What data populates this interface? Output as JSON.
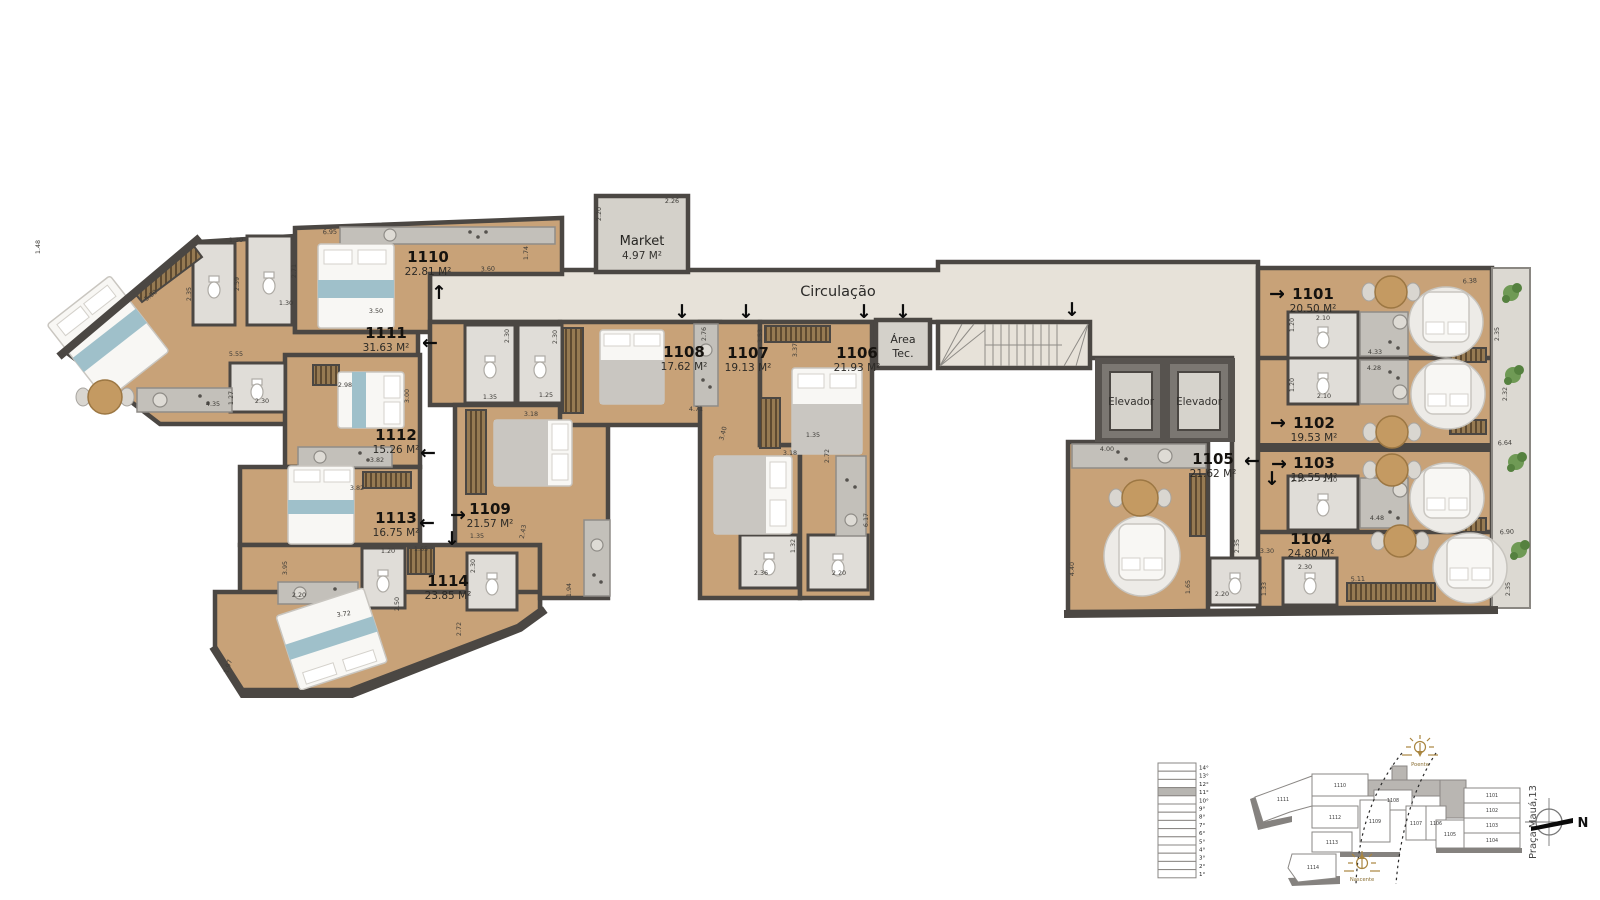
{
  "plan": {
    "rooms": {
      "market": {
        "name": "Market",
        "area": "4.97 M²",
        "x": 642,
        "y": 241
      },
      "circulation": {
        "name": "Circulação",
        "x": 838,
        "y": 292
      },
      "area_tec": {
        "line1": "Área",
        "line2": "Tec.",
        "x": 903,
        "y": 342
      },
      "elevators": [
        {
          "label": "Elevador",
          "x": 1131,
          "y": 405
        },
        {
          "label": "Elevador",
          "x": 1199,
          "y": 405
        }
      ]
    },
    "units": [
      {
        "number": "1110",
        "area": "22.81 M²",
        "x": 428,
        "y": 262
      },
      {
        "number": "1111",
        "area": "31.63 M²",
        "x": 386,
        "y": 338
      },
      {
        "number": "1112",
        "area": "15.26 M²",
        "x": 396,
        "y": 440
      },
      {
        "number": "1113",
        "area": "16.75 M²",
        "x": 396,
        "y": 523
      },
      {
        "number": "1114",
        "area": "23.85 M²",
        "x": 448,
        "y": 586
      },
      {
        "number": "1109",
        "area": "21.57 M²",
        "x": 490,
        "y": 514
      },
      {
        "number": "1108",
        "area": "17.62 M²",
        "x": 684,
        "y": 357
      },
      {
        "number": "1107",
        "area": "19.13 M²",
        "x": 748,
        "y": 358
      },
      {
        "number": "1106",
        "area": "21.93 M²",
        "x": 857,
        "y": 358
      },
      {
        "number": "1105",
        "area": "21.62 M²",
        "x": 1213,
        "y": 464
      },
      {
        "number": "1101",
        "area": "20.50 M²",
        "x": 1313,
        "y": 299
      },
      {
        "number": "1102",
        "area": "19.53 M²",
        "x": 1314,
        "y": 428
      },
      {
        "number": "1103",
        "area": "19.55 M²",
        "x": 1314,
        "y": 468
      },
      {
        "number": "1104",
        "area": "24.80 M²",
        "x": 1311,
        "y": 544
      }
    ],
    "dimensions": [
      {
        "t": "5.00",
        "x": 152,
        "y": 297,
        "r": -38
      },
      {
        "t": "2.35",
        "x": 191,
        "y": 294,
        "r": -90
      },
      {
        "t": "1.48",
        "x": 40,
        "y": 247,
        "r": -90
      },
      {
        "t": "1.30",
        "x": 236,
        "y": 242,
        "r": 0
      },
      {
        "t": "2.59",
        "x": 239,
        "y": 284,
        "r": -90
      },
      {
        "t": "2.71",
        "x": 296,
        "y": 271,
        "r": -90
      },
      {
        "t": "1.30",
        "x": 286,
        "y": 305,
        "r": 0
      },
      {
        "t": "6.95",
        "x": 330,
        "y": 234,
        "r": -2
      },
      {
        "t": "3.50",
        "x": 376,
        "y": 313,
        "r": 0
      },
      {
        "t": "3.60",
        "x": 488,
        "y": 271,
        "r": -3
      },
      {
        "t": "1.74",
        "x": 528,
        "y": 253,
        "r": -90
      },
      {
        "t": "2.20",
        "x": 601,
        "y": 214,
        "r": -90
      },
      {
        "t": "2.26",
        "x": 672,
        "y": 203,
        "r": 0
      },
      {
        "t": "5.55",
        "x": 236,
        "y": 356,
        "r": 0
      },
      {
        "t": "1.27",
        "x": 233,
        "y": 398,
        "r": -90
      },
      {
        "t": "4.35",
        "x": 213,
        "y": 406,
        "r": 0
      },
      {
        "t": "2.30",
        "x": 262,
        "y": 403,
        "r": 0
      },
      {
        "t": "2.98",
        "x": 345,
        "y": 387,
        "r": 0
      },
      {
        "t": "3.00",
        "x": 409,
        "y": 396,
        "r": -90
      },
      {
        "t": "3.82",
        "x": 377,
        "y": 462,
        "r": 0
      },
      {
        "t": "3.82",
        "x": 357,
        "y": 490,
        "r": 0
      },
      {
        "t": "3.95",
        "x": 287,
        "y": 568,
        "r": -90
      },
      {
        "t": "2.20",
        "x": 299,
        "y": 597,
        "r": 0
      },
      {
        "t": "1.20",
        "x": 388,
        "y": 553,
        "r": 0
      },
      {
        "t": "1.65",
        "x": 421,
        "y": 551,
        "r": 0
      },
      {
        "t": "2.50",
        "x": 399,
        "y": 604,
        "r": -90
      },
      {
        "t": "3.72",
        "x": 344,
        "y": 616,
        "r": -8
      },
      {
        "t": "1.97",
        "x": 230,
        "y": 667,
        "r": -72
      },
      {
        "t": "2.72",
        "x": 461,
        "y": 629,
        "r": -90
      },
      {
        "t": "2.30",
        "x": 475,
        "y": 566,
        "r": -90
      },
      {
        "t": "1.94",
        "x": 571,
        "y": 590,
        "r": -90
      },
      {
        "t": "2.30",
        "x": 509,
        "y": 336,
        "r": -90
      },
      {
        "t": "2.30",
        "x": 557,
        "y": 337,
        "r": -90
      },
      {
        "t": "1.35",
        "x": 490,
        "y": 399,
        "r": 0
      },
      {
        "t": "1.25",
        "x": 546,
        "y": 397,
        "r": 0
      },
      {
        "t": "3.18",
        "x": 531,
        "y": 416,
        "r": 0
      },
      {
        "t": "1.35",
        "x": 477,
        "y": 538,
        "r": 0
      },
      {
        "t": "2.43",
        "x": 525,
        "y": 532,
        "r": -80
      },
      {
        "t": "2.76",
        "x": 706,
        "y": 334,
        "r": -90
      },
      {
        "t": "3.53",
        "x": 762,
        "y": 336,
        "r": -90
      },
      {
        "t": "3.37",
        "x": 797,
        "y": 350,
        "r": -90
      },
      {
        "t": "4.71",
        "x": 696,
        "y": 411,
        "r": 0
      },
      {
        "t": "3.40",
        "x": 725,
        "y": 434,
        "r": -75
      },
      {
        "t": "3.18",
        "x": 790,
        "y": 455,
        "r": 0
      },
      {
        "t": "1.35",
        "x": 813,
        "y": 437,
        "r": 0
      },
      {
        "t": "2.72",
        "x": 829,
        "y": 456,
        "r": -90
      },
      {
        "t": "6.17",
        "x": 868,
        "y": 520,
        "r": -90
      },
      {
        "t": "2.36",
        "x": 761,
        "y": 575,
        "r": 0
      },
      {
        "t": "1.32",
        "x": 795,
        "y": 546,
        "r": -90
      },
      {
        "t": "2.20",
        "x": 839,
        "y": 575,
        "r": 0
      },
      {
        "t": "6.38",
        "x": 1470,
        "y": 283,
        "r": -4
      },
      {
        "t": "2.10",
        "x": 1323,
        "y": 320,
        "r": 0
      },
      {
        "t": "1.20",
        "x": 1294,
        "y": 325,
        "r": -90
      },
      {
        "t": "4.33",
        "x": 1375,
        "y": 354,
        "r": 0
      },
      {
        "t": "4.28",
        "x": 1374,
        "y": 370,
        "r": 0
      },
      {
        "t": "2.35",
        "x": 1499,
        "y": 334,
        "r": -90
      },
      {
        "t": "2.10",
        "x": 1324,
        "y": 398,
        "r": 0
      },
      {
        "t": "1.20",
        "x": 1294,
        "y": 385,
        "r": -90
      },
      {
        "t": "2.32",
        "x": 1507,
        "y": 394,
        "r": -90
      },
      {
        "t": "6.64",
        "x": 1505,
        "y": 445,
        "r": -3
      },
      {
        "t": "2.10",
        "x": 1298,
        "y": 482,
        "r": 0
      },
      {
        "t": "2.10",
        "x": 1330,
        "y": 482,
        "r": 0
      },
      {
        "t": "4.48",
        "x": 1377,
        "y": 520,
        "r": 0
      },
      {
        "t": "4.00",
        "x": 1107,
        "y": 451,
        "r": 0
      },
      {
        "t": "4.40",
        "x": 1074,
        "y": 569,
        "r": -90
      },
      {
        "t": "2.35",
        "x": 1239,
        "y": 546,
        "r": -90
      },
      {
        "t": "1.65",
        "x": 1190,
        "y": 587,
        "r": -90
      },
      {
        "t": "2.20",
        "x": 1222,
        "y": 596,
        "r": 0
      },
      {
        "t": "1.33",
        "x": 1266,
        "y": 589,
        "r": -90
      },
      {
        "t": "2.30",
        "x": 1305,
        "y": 569,
        "r": 0
      },
      {
        "t": "3.30",
        "x": 1267,
        "y": 553,
        "r": 0
      },
      {
        "t": "5.11",
        "x": 1358,
        "y": 581,
        "r": -3
      },
      {
        "t": "2.35",
        "x": 1510,
        "y": 589,
        "r": -90
      },
      {
        "t": "6.90",
        "x": 1507,
        "y": 534,
        "r": -3
      }
    ],
    "arrows": [
      {
        "d": "up",
        "x": 439,
        "y": 299
      },
      {
        "d": "left",
        "x": 430,
        "y": 349
      },
      {
        "d": "left",
        "x": 428,
        "y": 459
      },
      {
        "d": "left",
        "x": 427,
        "y": 529
      },
      {
        "d": "right",
        "x": 458,
        "y": 521
      },
      {
        "d": "down",
        "x": 452,
        "y": 545
      },
      {
        "d": "down",
        "x": 682,
        "y": 318
      },
      {
        "d": "down",
        "x": 746,
        "y": 318
      },
      {
        "d": "down",
        "x": 864,
        "y": 318
      },
      {
        "d": "down",
        "x": 903,
        "y": 318
      },
      {
        "d": "down",
        "x": 1072,
        "y": 316
      },
      {
        "d": "right",
        "x": 1277,
        "y": 300
      },
      {
        "d": "right",
        "x": 1278,
        "y": 429
      },
      {
        "d": "left",
        "x": 1252,
        "y": 467
      },
      {
        "d": "right",
        "x": 1279,
        "y": 470
      },
      {
        "d": "down",
        "x": 1272,
        "y": 485
      }
    ],
    "colors": {
      "wall": "#4b4743",
      "wood_floor": "#c8a278",
      "common_floor": "#e7e2d9",
      "bath_floor": "#e0ddd8",
      "accent_blue": "#9fc0ca",
      "sun_icon": "#a9853f"
    }
  },
  "legend": {
    "floors": [
      "14°",
      "13°",
      "12°",
      "11°",
      "10°",
      "9°",
      "8°",
      "7°",
      "6°",
      "5°",
      "4°",
      "3°",
      "2°",
      "1°"
    ],
    "highlight_floor": "11°",
    "highlight_index": 3,
    "keyplan_units": [
      {
        "id": "1110",
        "x": 1340,
        "y": 787
      },
      {
        "id": "1111",
        "x": 1283,
        "y": 801
      },
      {
        "id": "1112",
        "x": 1335,
        "y": 819
      },
      {
        "id": "1113",
        "x": 1332,
        "y": 844
      },
      {
        "id": "1114",
        "x": 1313,
        "y": 869
      },
      {
        "id": "1109",
        "x": 1375,
        "y": 823
      },
      {
        "id": "1108",
        "x": 1393,
        "y": 802
      },
      {
        "id": "1107",
        "x": 1416,
        "y": 825
      },
      {
        "id": "1106",
        "x": 1436,
        "y": 825
      },
      {
        "id": "1105",
        "x": 1450,
        "y": 836
      },
      {
        "id": "1101",
        "x": 1492,
        "y": 797
      },
      {
        "id": "1102",
        "x": 1492,
        "y": 812
      },
      {
        "id": "1103",
        "x": 1492,
        "y": 827
      },
      {
        "id": "1104",
        "x": 1492,
        "y": 842
      }
    ],
    "sun_top": {
      "label": "Poente",
      "x": 1420,
      "y": 766
    },
    "sun_bottom": {
      "label": "Nascente",
      "x": 1362,
      "y": 881
    },
    "address": {
      "text": "Praça Mauá,13",
      "x": 1536,
      "y": 822
    },
    "compass_label": "N"
  }
}
